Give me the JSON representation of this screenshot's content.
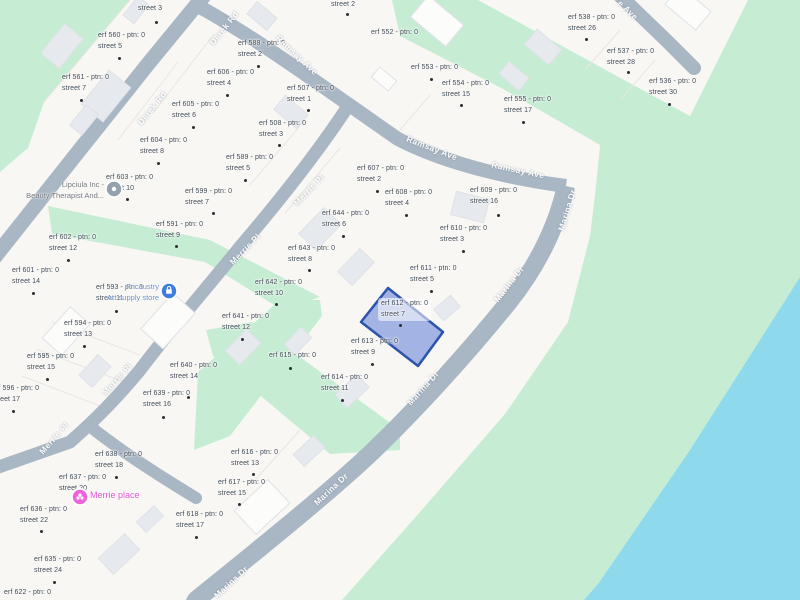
{
  "map": {
    "colors": {
      "land": "#f8f7f4",
      "park": "#c6edd4",
      "water": "#8ed9ec",
      "road": "#a9b6c3",
      "road_text": "#ffffff",
      "building_gray": "#e6e9ed",
      "building_white": "#fcfcfb",
      "building_stroke": "#dfe2e6",
      "lot_line": "#e9e6e0",
      "parcel_text": "#414b55",
      "dot": "#2a2f35",
      "highlight_fill": "rgba(77,112,210,0.5)",
      "highlight_stroke": "#2d53ab"
    },
    "highlighted_parcel": {
      "erf": "erf 612 - ptn: 0",
      "street": "street 7",
      "polygon": [
        [
          388,
          288
        ],
        [
          443,
          332
        ],
        [
          418,
          366
        ],
        [
          361,
          322
        ]
      ]
    },
    "street_labels": [
      {
        "text": "Derek Rd",
        "x": 152,
        "y": 108,
        "rot": -51
      },
      {
        "text": "Derek Rd",
        "x": 224,
        "y": 28,
        "rot": -51
      },
      {
        "text": "Ramsay Ave",
        "x": 297,
        "y": 55,
        "rot": 43
      },
      {
        "text": "Ramsay Ave",
        "x": 432,
        "y": 148,
        "rot": 21
      },
      {
        "text": "Ramsay Ave",
        "x": 518,
        "y": 170,
        "rot": 12
      },
      {
        "text": "Marina Dr",
        "x": 567,
        "y": 210,
        "rot": -73
      },
      {
        "text": "Marina Dr",
        "x": 509,
        "y": 284,
        "rot": -52
      },
      {
        "text": "Marina Dr",
        "x": 423,
        "y": 388,
        "rot": -48
      },
      {
        "text": "Marina Dr",
        "x": 331,
        "y": 489,
        "rot": -43
      },
      {
        "text": "Marina Dr",
        "x": 231,
        "y": 582,
        "rot": -43
      },
      {
        "text": "Merrie Pl",
        "x": 309,
        "y": 190,
        "rot": -46
      },
      {
        "text": "Merrie Pl",
        "x": 245,
        "y": 249,
        "rot": -46
      },
      {
        "text": "Merrie Pl",
        "x": 117,
        "y": 379,
        "rot": -48
      },
      {
        "text": "Merrie Pl",
        "x": 54,
        "y": 438,
        "rot": -48
      },
      {
        "text": "e Ave",
        "x": 628,
        "y": 10,
        "rot": 43
      }
    ],
    "parcels": [
      {
        "erf": "",
        "street": "street 3",
        "x": 138,
        "y": 4,
        "dot": [
          155,
          21
        ]
      },
      {
        "erf": "erf 560 - ptn: 0",
        "street": "street 5",
        "x": 98,
        "y": 31,
        "dot": [
          118,
          57
        ]
      },
      {
        "erf": "erf 561 - ptn: 0",
        "street": "street 7",
        "x": 62,
        "y": 73,
        "dot": [
          80,
          99
        ]
      },
      {
        "erf": "erf 604 - ptn: 0",
        "street": "street 8",
        "x": 140,
        "y": 136,
        "dot": [
          157,
          162
        ]
      },
      {
        "erf": "erf 605 - ptn: 0",
        "street": "street 6",
        "x": 172,
        "y": 100,
        "dot": [
          192,
          126
        ]
      },
      {
        "erf": "erf 606 - ptn: 0",
        "street": "street 4",
        "x": 207,
        "y": 68,
        "dot": [
          226,
          94
        ]
      },
      {
        "erf": "erf 588 - ptn: 0",
        "street": "street 2",
        "x": 238,
        "y": 39,
        "dot": [
          257,
          65
        ]
      },
      {
        "erf": "",
        "street": "street 2",
        "x": 331,
        "y": 0,
        "dot": [
          346,
          13
        ]
      },
      {
        "erf": "erf 507 - ptn: 0",
        "street": "street 1",
        "x": 287,
        "y": 84,
        "dot": [
          307,
          109
        ]
      },
      {
        "erf": "erf 508 - ptn: 0",
        "street": "street 3",
        "x": 259,
        "y": 119,
        "dot": [
          278,
          144
        ]
      },
      {
        "erf": "erf 552 - ptn: 0",
        "street": "",
        "x": 371,
        "y": 28,
        "dot": null
      },
      {
        "erf": "erf 553 - ptn: 0",
        "street": "",
        "x": 411,
        "y": 63,
        "dot": [
          430,
          78
        ]
      },
      {
        "erf": "erf 554 - ptn: 0",
        "street": "street 15",
        "x": 442,
        "y": 79,
        "dot": [
          460,
          104
        ]
      },
      {
        "erf": "erf 555 - ptn: 0",
        "street": "street 17",
        "x": 504,
        "y": 95,
        "dot": [
          522,
          121
        ]
      },
      {
        "erf": "erf 538 - ptn: 0",
        "street": "street 26",
        "x": 568,
        "y": 13,
        "dot": [
          585,
          38
        ]
      },
      {
        "erf": "erf 537 - ptn: 0",
        "street": "street 28",
        "x": 607,
        "y": 47,
        "dot": [
          627,
          71
        ]
      },
      {
        "erf": "erf 536 - ptn: 0",
        "street": "street 30",
        "x": 649,
        "y": 77,
        "dot": [
          668,
          103
        ]
      },
      {
        "erf": "erf 589 - ptn: 0",
        "street": "street 5",
        "x": 226,
        "y": 153,
        "dot": [
          244,
          179
        ]
      },
      {
        "erf": "erf 599 - ptn: 0",
        "street": "street 7",
        "x": 185,
        "y": 187,
        "dot": [
          212,
          212
        ]
      },
      {
        "erf": "erf 607 - ptn: 0",
        "street": "street 2",
        "x": 357,
        "y": 164,
        "dot": [
          376,
          190
        ]
      },
      {
        "erf": "erf 608 - ptn: 0",
        "street": "street 4",
        "x": 385,
        "y": 188,
        "dot": [
          405,
          214
        ]
      },
      {
        "erf": "erf 609 - ptn: 0",
        "street": "street 16",
        "x": 470,
        "y": 186,
        "dot": [
          497,
          214
        ]
      },
      {
        "erf": "erf 610 - ptn: 0",
        "street": "street 3",
        "x": 440,
        "y": 224,
        "dot": [
          462,
          250
        ]
      },
      {
        "erf": "erf 611 - ptn: 0",
        "street": "street 5",
        "x": 410,
        "y": 264,
        "dot": [
          430,
          290
        ]
      },
      {
        "erf": "erf 644 - ptn: 0",
        "street": "street 6",
        "x": 322,
        "y": 209,
        "dot": [
          342,
          235
        ]
      },
      {
        "erf": "erf 643 - ptn: 0",
        "street": "street 8",
        "x": 288,
        "y": 244,
        "dot": [
          308,
          269
        ]
      },
      {
        "erf": "erf 642 - ptn: 0",
        "street": "street 10",
        "x": 255,
        "y": 278,
        "dot": [
          275,
          303
        ]
      },
      {
        "erf": "erf 603 - ptn: 0",
        "street": "street 10",
        "x": 106,
        "y": 173,
        "dot": [
          126,
          198
        ]
      },
      {
        "erf": "erf 591 - ptn: 0",
        "street": "street 9",
        "x": 156,
        "y": 220,
        "dot": [
          175,
          245
        ]
      },
      {
        "erf": "erf 602 - ptn: 0",
        "street": "street 12",
        "x": 49,
        "y": 233,
        "dot": [
          67,
          259
        ]
      },
      {
        "erf": "erf 601 - ptn: 0",
        "street": "street 14",
        "x": 12,
        "y": 266,
        "dot": [
          32,
          292
        ]
      },
      {
        "erf": "erf 593 - ptn: 0",
        "street": "street 11",
        "x": 96,
        "y": 283,
        "dot": [
          115,
          310
        ]
      },
      {
        "erf": "erf 594 - ptn: 0",
        "street": "street 13",
        "x": 64,
        "y": 319,
        "dot": [
          83,
          345
        ]
      },
      {
        "erf": "erf 595 - ptn: 0",
        "street": "street 15",
        "x": 27,
        "y": 352,
        "dot": [
          46,
          378
        ]
      },
      {
        "erf": "erf 596 - ptn: 0",
        "street": "street 17",
        "x": -8,
        "y": 384,
        "dot": [
          12,
          410
        ]
      },
      {
        "erf": "erf 640 - ptn: 0",
        "street": "street 14",
        "x": 170,
        "y": 361,
        "dot": [
          187,
          396
        ]
      },
      {
        "erf": "erf 639 - ptn: 0",
        "street": "street 16",
        "x": 143,
        "y": 389,
        "dot": [
          162,
          416
        ]
      },
      {
        "erf": "erf 641 - ptn: 0",
        "street": "street 12",
        "x": 222,
        "y": 312,
        "dot": [
          241,
          338
        ]
      },
      {
        "erf": "erf 615 - ptn: 0",
        "street": "",
        "x": 269,
        "y": 351,
        "dot": [
          289,
          367
        ]
      },
      {
        "erf": "erf 613 - ptn: 0",
        "street": "street 9",
        "x": 351,
        "y": 337,
        "dot": [
          371,
          363
        ]
      },
      {
        "erf": "erf 614 - ptn: 0",
        "street": "street 11",
        "x": 321,
        "y": 373,
        "dot": [
          341,
          399
        ]
      },
      {
        "erf": "erf 612 - ptn: 0",
        "street": "street 7",
        "x": 381,
        "y": 299,
        "dot": [
          399,
          324
        ],
        "chip": true
      },
      {
        "erf": "erf 638 - ptn: 0",
        "street": "street 18",
        "x": 95,
        "y": 450,
        "dot": [
          115,
          476
        ]
      },
      {
        "erf": "erf 637 - ptn: 0",
        "street": "street 20",
        "x": 59,
        "y": 473,
        "dot": null
      },
      {
        "erf": "erf 636 - ptn: 0",
        "street": "street 22",
        "x": 20,
        "y": 505,
        "dot": [
          40,
          530
        ]
      },
      {
        "erf": "erf 635 - ptn: 0",
        "street": "street 24",
        "x": 34,
        "y": 555,
        "dot": [
          53,
          581
        ]
      },
      {
        "erf": "erf 622 - ptn: 0",
        "street": "",
        "x": 4,
        "y": 588,
        "dot": null
      },
      {
        "erf": "erf 616 - ptn: 0",
        "street": "street 13",
        "x": 231,
        "y": 448,
        "dot": [
          252,
          473
        ]
      },
      {
        "erf": "erf 617 - ptn: 0",
        "street": "street 15",
        "x": 218,
        "y": 478,
        "dot": [
          238,
          503
        ]
      },
      {
        "erf": "erf 618 - ptn: 0",
        "street": "street 17",
        "x": 176,
        "y": 510,
        "dot": [
          195,
          536
        ]
      }
    ],
    "pois": [
      {
        "id": "lipciula",
        "lines": [
          "Lipciula Inc -",
          "Beauty Therapist And..."
        ],
        "icon": "spa-icon",
        "icon_color": "#94a2ae",
        "text_color": "#75797e",
        "icon_x": 114,
        "icon_y": 189,
        "anchor_x": 104,
        "text_y": 180,
        "align": "right",
        "big": false
      },
      {
        "id": "fricaustry",
        "lines": [
          "Fricaustry",
          "Art supply store"
        ],
        "icon": "shopping-bag-icon",
        "icon_color": "#3c7de0",
        "text_color": "#6e95cc",
        "icon_x": 169,
        "icon_y": 291,
        "anchor_x": 159,
        "text_y": 282,
        "align": "right",
        "big": false
      },
      {
        "id": "merrie-place",
        "lines": [
          "Merrie place"
        ],
        "icon": "flower-icon",
        "icon_color": "#ef63da",
        "text_color": "#e356d6",
        "icon_x": 80,
        "icon_y": 497,
        "anchor_x": 90,
        "text_y": 490,
        "align": "left",
        "big": true
      }
    ]
  }
}
